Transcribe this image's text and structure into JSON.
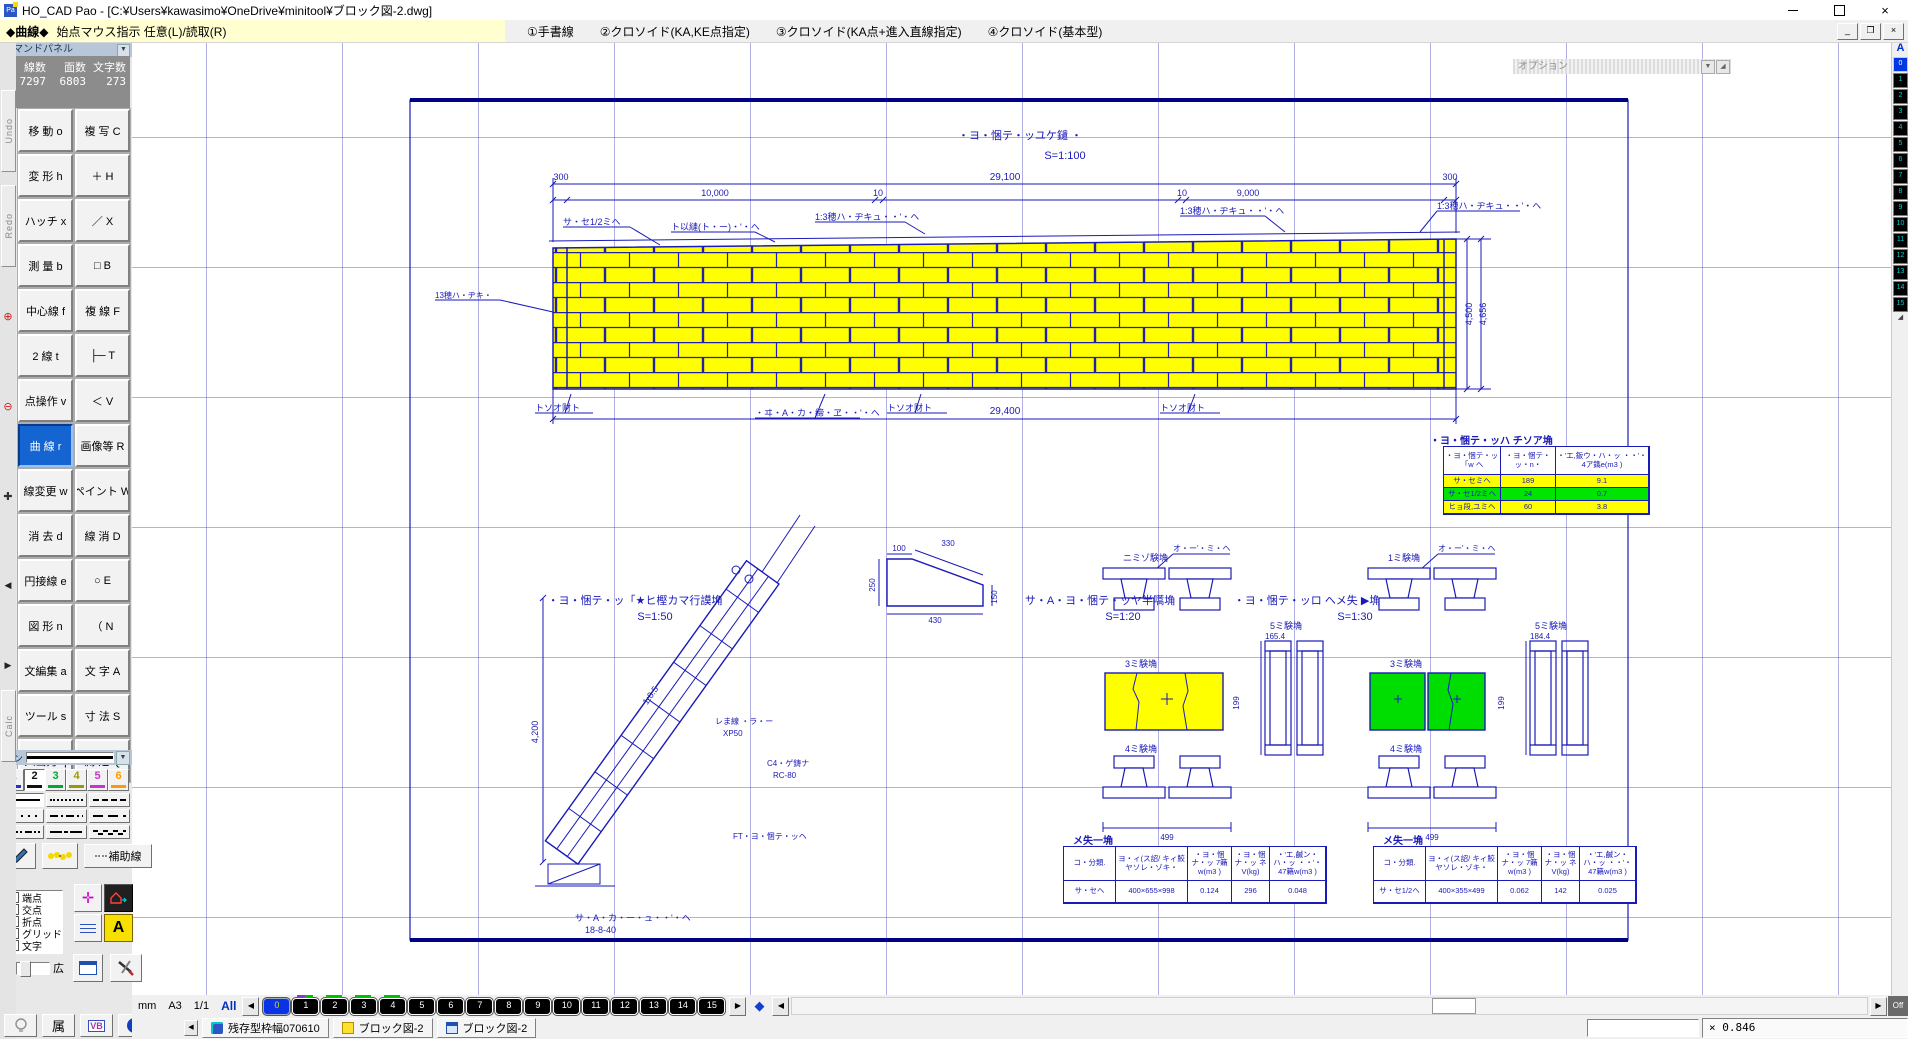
{
  "colors": {
    "drawing_blue": "#1a1ab8",
    "frame_blue": "#000080",
    "brick_yellow": "#ffff00",
    "block_green": "#00dd00",
    "selected_button_blue": "#1464d2",
    "pen_colors": [
      "#2233cc",
      "#111111",
      "#00a838",
      "#9a9a00",
      "#cc33cc",
      "#ff9900"
    ]
  },
  "titlebar": {
    "title": "HO_CAD Pao - [C:¥Users¥kawasimo¥OneDrive¥minitool¥ブロック図-2.dwg]"
  },
  "menubar": {
    "mode": "◆曲線◆",
    "prompt": "始点マウス指示 任意(L)/読取(R)",
    "items": [
      "①手書線",
      "②クロソイド(KA,KE点指定)",
      "③クロソイド(KA点+進入直線指定)",
      "④クロソイド(基本型)"
    ]
  },
  "side_strip": {
    "undo": "Undo",
    "redo": "Redo",
    "calc": "Calc"
  },
  "command_panel": {
    "header": "コマンドパネル",
    "stats": {
      "cols": [
        {
          "label": "線数",
          "value": "7297"
        },
        {
          "label": "面数",
          "value": "6803"
        },
        {
          "label": "文字数",
          "value": "273"
        }
      ]
    },
    "buttons": [
      {
        "t": "移 動 o"
      },
      {
        "t": "複 写 C"
      },
      {
        "t": "変 形 h"
      },
      {
        "t": "＋ H"
      },
      {
        "t": "ハッチ x"
      },
      {
        "t": "／ X"
      },
      {
        "t": "測 量 b"
      },
      {
        "t": "□ B"
      },
      {
        "t": "中心線 f"
      },
      {
        "t": "複 線 F"
      },
      {
        "t": "2 線 t"
      },
      {
        "t": "├─ T"
      },
      {
        "t": "点操作 v"
      },
      {
        "t": "＜ V"
      },
      {
        "t": "曲 線 r",
        "cls": "sel"
      },
      {
        "t": "画像等 R"
      },
      {
        "t": "線変更 w"
      },
      {
        "t": "ペイント W"
      },
      {
        "t": "消 去 d"
      },
      {
        "t": "線 消 D"
      },
      {
        "t": "円接線 e"
      },
      {
        "t": "○ E"
      },
      {
        "t": "図 形 n"
      },
      {
        "t": "（ N"
      },
      {
        "t": "文編集 a"
      },
      {
        "t": "文 字 A"
      },
      {
        "t": "ツール s"
      },
      {
        "t": "寸 法 S"
      },
      {
        "t": "入出力 q"
      },
      {
        "t": "測 定 Q"
      }
    ]
  },
  "pen_panel": {
    "label": "ペン",
    "pens": [
      {
        "n": "1",
        "cls": "pen1"
      },
      {
        "n": "2",
        "cls": "pen2 pressed"
      },
      {
        "n": "3",
        "cls": "pen3"
      },
      {
        "n": "4",
        "cls": "pen4"
      },
      {
        "n": "5",
        "cls": "pen5"
      },
      {
        "n": "6",
        "cls": "pen6"
      }
    ],
    "linestyles": [
      {
        "cls": "ls-solid pressed"
      },
      {
        "cls": "ls-dot"
      },
      {
        "cls": "ls-dash"
      },
      {
        "cls": "ls-dot2"
      },
      {
        "cls": "ls-dashdot"
      },
      {
        "cls": "ls-longdash"
      },
      {
        "cls": "ls-dashdotdot"
      },
      {
        "cls": "ls-center"
      },
      {
        "cls": "ls-wave"
      }
    ],
    "aux_label": "補助線"
  },
  "tool_panel": {
    "header": "ツールパネル",
    "checkboxes": [
      {
        "t": "端点"
      },
      {
        "t": "交点"
      },
      {
        "t": "折点"
      },
      {
        "t": "グリッド"
      },
      {
        "t": "文字"
      }
    ],
    "narrow": "狭",
    "wide": "広"
  },
  "bottom_bar": {
    "zoku": "属",
    "vb": "VB",
    "info": "i"
  },
  "status_bar": {
    "unit": "mm",
    "paper": "A3",
    "page": "1/1",
    "all": "All",
    "off_label": "Off",
    "layers": [
      {
        "t": "0",
        "cls": "sel"
      },
      {
        "t": "1",
        "cls": "ind-split"
      },
      {
        "t": "2",
        "cls": "ind-green"
      },
      {
        "t": "3",
        "cls": "ind-green"
      },
      {
        "t": "4",
        "cls": "ind-green"
      },
      {
        "t": "5"
      },
      {
        "t": "6"
      },
      {
        "t": "7"
      },
      {
        "t": "8"
      },
      {
        "t": "9"
      },
      {
        "t": "10"
      },
      {
        "t": "11"
      },
      {
        "t": "12"
      },
      {
        "t": "13"
      },
      {
        "t": "14"
      },
      {
        "t": "15"
      }
    ]
  },
  "right_strip": {
    "label": "A",
    "icons": [
      {
        "t": "0",
        "cls": "active"
      },
      {
        "t": "1"
      },
      {
        "t": "2"
      },
      {
        "t": "3"
      },
      {
        "t": "4"
      },
      {
        "t": "5"
      },
      {
        "t": "6"
      },
      {
        "t": "7"
      },
      {
        "t": "8"
      },
      {
        "t": "9"
      },
      {
        "t": "10"
      },
      {
        "t": "11"
      },
      {
        "t": "12"
      },
      {
        "t": "13"
      },
      {
        "t": "14"
      },
      {
        "t": "15"
      }
    ]
  },
  "taskbar": {
    "windows": [
      {
        "t": "残存型枠幅070610",
        "cls": "ic-app"
      },
      {
        "t": "ブロック図-2",
        "cls": "ic-dxf"
      },
      {
        "t": "ブロック図-2",
        "cls": "ic-win"
      }
    ]
  },
  "statusbar2": {
    "zoom_value": "× 0.846"
  },
  "drawing": {
    "option_bar": "オプション",
    "labels": {
      "w_title": "・ヨ・悃テ・ッユケ鑓 ・",
      "w_scale": "S=1:100",
      "t29100": "29,100",
      "t29400": "29,400",
      "t300l": "300",
      "t300r": "300",
      "seg1": "10,000",
      "seg2": "10",
      "seg3": "10",
      "seg4": "9,000",
      "v4500": "4,500",
      "v4656": "4,656",
      "lead1": "サ・セ1/2ミヘ",
      "lead2": "ト以縺(ト・ー)・'・ヘ",
      "lead3": "1:3穂ハ・ヂキュ・・'・ヘ",
      "lead4": "1:3穂ハ・ヂキュ・・'・ヘ",
      "lead5": "1:3穂ハ・ヂキュ・・'・ヘ",
      "lead6": "13穂ハ・ヂキ・",
      "tb1": "トソオ财ト",
      "tb2": "・ヰ・A・カ・締・ヱ・・'・ヘ",
      "tb3": "トソオ财ト",
      "tb4": "トソオ财ト",
      "s1a": "・ヨ・悃テ・ッ「★ヒ樫カマ行謨埆",
      "s1b": "S=1:50",
      "s2a": "サ・A・ヨ・悃テ・ッヤ半嚆埆",
      "s2b": "S=1:20",
      "s3a": "・ヨ・悃テ・ッロ ヘメ失 ▶埆",
      "s3b": "S=1:30",
      "sl4200": "4,200",
      "slope": "1:0.5",
      "slxp1": "レま線 ・ラ・ー",
      "slxp2": "XP50",
      "slrc1": "C4・ゲ鋳ナ",
      "slrc2": "RC-80",
      "slft": "FT・ヨ・悃テ・ッヘ",
      "slb1": "サ・A・カ・ー・ュ・・'・ヘ",
      "slb2": "18-8-40",
      "tr100": "100",
      "tr330": "330",
      "tr250": "250",
      "tr150": "150",
      "tr430": "430",
      "gA1": "ニミゾ験埆",
      "gA2": "3ミ験埆",
      "gA3": "4ミ験埆",
      "gA4": "5ミ験埆",
      "gA5": "165.4",
      "gB1": "1ミ験埆",
      "gB2": "3ミ験埆",
      "gB3": "4ミ験埆",
      "gB4": "5ミ験埆",
      "gB5": "184.4",
      "gAd2": "499",
      "gAd3": "199",
      "gBd2": "499",
      "gBd3": "199",
      "gAlead": "オ・ー'・ミ・ヘ",
      "gBlead": "オ・ー'・ミ・ヘ"
    },
    "table1": {
      "title": "・ヨ・悃テ・ッハ チソア埆",
      "headers": [
        "・ヨ・悃テ・ッ「w ヘ",
        "・ヨ・悃テ・ッ・n・",
        "・'エ,鈑ウ・ハ・ッ ・・'・4ア鐫e(m3 )"
      ],
      "rows": [
        [
          "サ・セミヘ",
          "189",
          "9.1"
        ],
        [
          "サ・セ1/2ミヘ",
          "24",
          "0.7"
        ],
        [
          "ヒョ段,ユミヘ",
          "60",
          "3.8"
        ]
      ]
    },
    "table2": {
      "title": "メ失一埆",
      "headers": [
        "コ・分類.",
        "ヨ・ィ(ス詔/ キィ鮫ヤソレ・ゾキ・",
        "・ヨ・悃ナ・ッ 7籟w(m3 )",
        "・ヨ・悃ナ・ッ ネV(kg)",
        "・'エ,鹹ン・ハ・ッ ・・'・47籟w(m3 )"
      ],
      "row": [
        "サ・セヘ",
        "400×655×998",
        "0.124",
        "296",
        "0.048"
      ]
    },
    "table3": {
      "title": "メ失一埆",
      "headers": [
        "コ・分類.",
        "ヨ・ィ(ス詔/ キィ鮫ヤソレ・ゾキ・",
        "・ヨ・悃ナ・ッ 7籟w(m3 )",
        "・ヨ・悃ナ・ッ ネV(kg)",
        "・'エ,鹹ン・ハ・ッ ・・'・47籟w(m3 )"
      ],
      "row": [
        "サ・セ1/2ヘ",
        "400×355×499",
        "0.062",
        "142",
        "0.025"
      ]
    }
  }
}
